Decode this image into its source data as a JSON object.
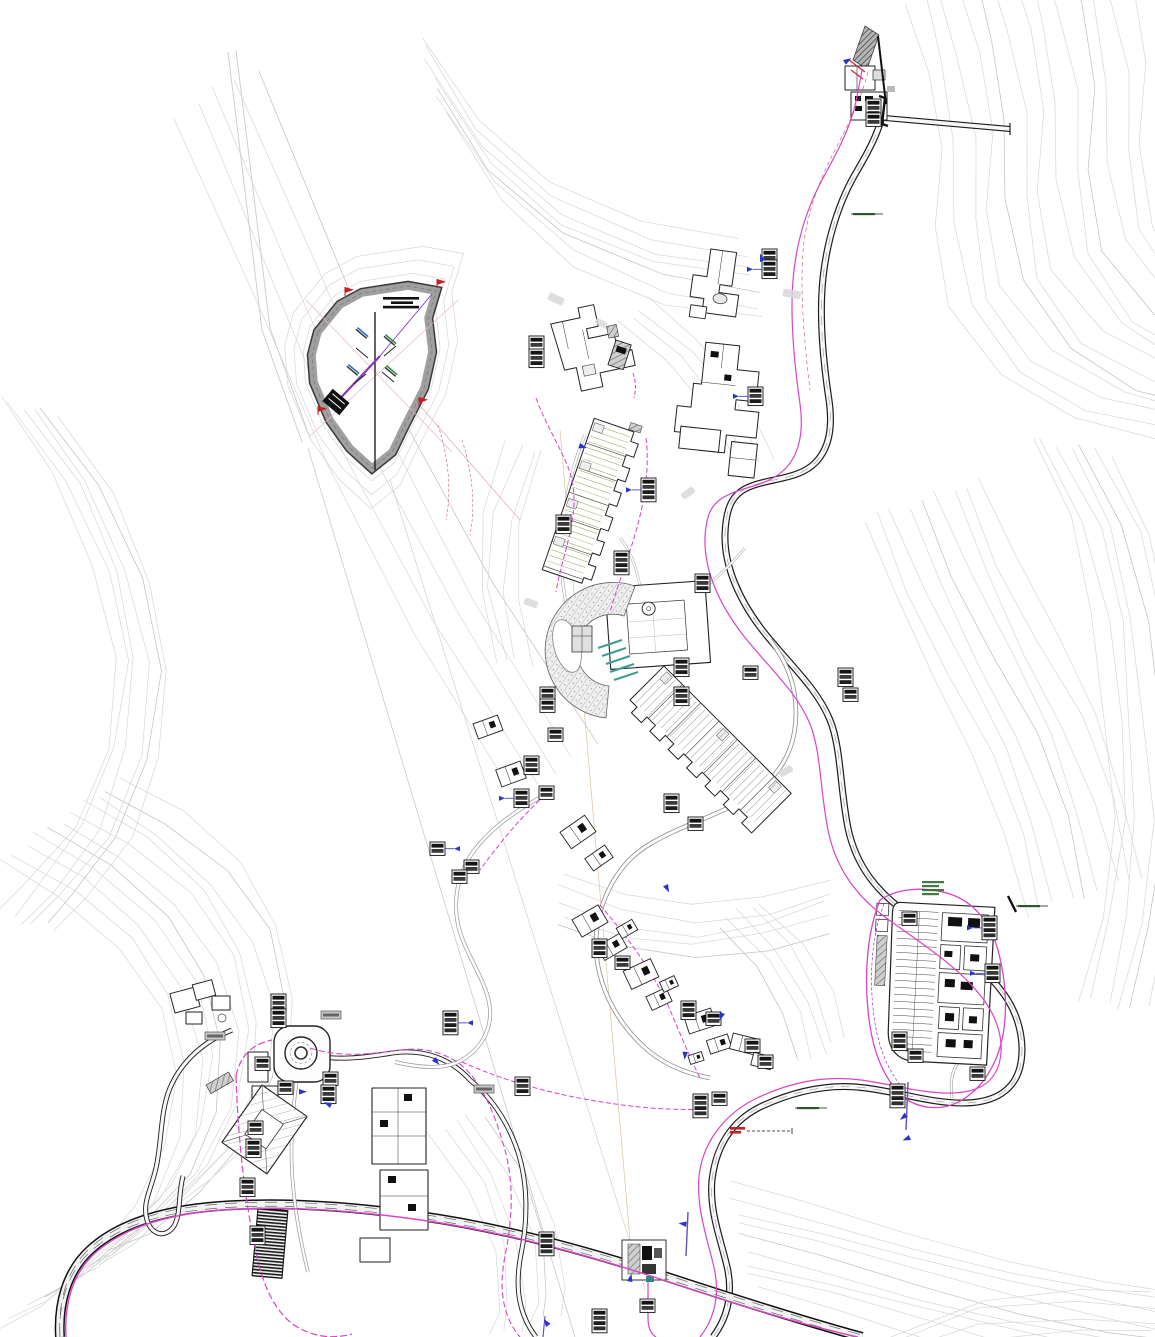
{
  "palette": {
    "background": "#ffffff",
    "contour": "#d9d9d9",
    "contour_dark": "#c2c2c2",
    "road_casing": "#1c1c1c",
    "road_fill": "#f7f7f7",
    "utility_magenta": "#d944c8",
    "utility_purple": "#8a35c0",
    "marker_blue": "#2a35c9",
    "marker_red": "#c22222",
    "building_stroke": "#222222",
    "terrace_green": "#9aa05a",
    "teal": "#3d9d96",
    "berm_gray": "#9a9a9a"
  },
  "callouts": [
    [
      866,
      99,
      3,
      ""
    ],
    [
      866,
      113,
      2,
      ""
    ],
    [
      529,
      336,
      2,
      ""
    ],
    [
      529,
      349,
      3,
      ""
    ],
    [
      641,
      478,
      4,
      "l"
    ],
    [
      556,
      515,
      3,
      ""
    ],
    [
      614,
      551,
      4,
      ""
    ],
    [
      762,
      249,
      2,
      ""
    ],
    [
      762,
      260,
      3,
      "l"
    ],
    [
      748,
      387,
      3,
      "l"
    ],
    [
      838,
      668,
      3,
      ""
    ],
    [
      843,
      688,
      2,
      ""
    ],
    [
      695,
      574,
      3,
      ""
    ],
    [
      674,
      658,
      3,
      ""
    ],
    [
      674,
      687,
      3,
      ""
    ],
    [
      743,
      666,
      2,
      ""
    ],
    [
      540,
      687,
      2,
      ""
    ],
    [
      540,
      699,
      2,
      ""
    ],
    [
      664,
      794,
      3,
      ""
    ],
    [
      688,
      817,
      2,
      ""
    ],
    [
      548,
      728,
      2,
      ""
    ],
    [
      524,
      756,
      3,
      ""
    ],
    [
      539,
      786,
      2,
      ""
    ],
    [
      514,
      789,
      3,
      "l"
    ],
    [
      430,
      842,
      2,
      "r"
    ],
    [
      464,
      860,
      2,
      ""
    ],
    [
      452,
      870,
      2,
      ""
    ],
    [
      592,
      939,
      3,
      ""
    ],
    [
      615,
      956,
      2,
      ""
    ],
    [
      681,
      1001,
      3,
      ""
    ],
    [
      706,
      1012,
      2,
      ""
    ],
    [
      745,
      1039,
      2,
      ""
    ],
    [
      758,
      1055,
      2,
      ""
    ],
    [
      271,
      994,
      3,
      ""
    ],
    [
      271,
      1009,
      3,
      ""
    ],
    [
      255,
      1057,
      2,
      ""
    ],
    [
      278,
      1081,
      2,
      ""
    ],
    [
      248,
      1121,
      2,
      ""
    ],
    [
      246,
      1139,
      3,
      ""
    ],
    [
      240,
      1178,
      3,
      ""
    ],
    [
      250,
      1226,
      3,
      ""
    ],
    [
      443,
      1011,
      4,
      "r"
    ],
    [
      515,
      1077,
      3,
      ""
    ],
    [
      539,
      1232,
      4,
      ""
    ],
    [
      592,
      1309,
      4,
      ""
    ],
    [
      693,
      1094,
      4,
      ""
    ],
    [
      712,
      1092,
      2,
      ""
    ],
    [
      890,
      1084,
      4,
      ""
    ],
    [
      982,
      916,
      4,
      "l"
    ],
    [
      985,
      964,
      3,
      "l"
    ],
    [
      902,
      912,
      2,
      ""
    ],
    [
      892,
      1032,
      3,
      ""
    ],
    [
      908,
      1049,
      2,
      ""
    ],
    [
      970,
      1067,
      2,
      ""
    ],
    [
      640,
      1299,
      2,
      ""
    ],
    [
      323,
      1072,
      2,
      ""
    ],
    [
      321,
      1085,
      3,
      ""
    ]
  ],
  "gray_tags": [
    [
      321,
      1011
    ],
    [
      474,
      1085
    ],
    [
      205,
      1032
    ]
  ],
  "flags": [
    [
      345,
      296
    ],
    [
      437,
      288
    ],
    [
      419,
      406
    ],
    [
      318,
      415
    ]
  ],
  "blue_markers": [
    [
      299,
      1089
    ],
    [
      436,
      1057
    ],
    [
      688,
      1052
    ],
    [
      908,
      1117
    ],
    [
      686,
      1227
    ],
    [
      546,
      1327
    ],
    [
      627,
      1281
    ],
    [
      843,
      60
    ],
    [
      580,
      443
    ],
    [
      668,
      884
    ],
    [
      725,
      1014
    ],
    [
      911,
      1140
    ],
    [
      330,
      1108
    ],
    [
      760,
      262
    ]
  ],
  "villas": [
    [
      488,
      727,
      26,
      16,
      -20
    ],
    [
      511,
      774,
      26,
      18,
      -20
    ],
    [
      578,
      832,
      30,
      20,
      -35
    ],
    [
      599,
      858,
      24,
      15,
      -35
    ],
    [
      590,
      921,
      30,
      20,
      -30
    ],
    [
      612,
      947,
      26,
      16,
      -30
    ],
    [
      627,
      929,
      18,
      12,
      -30
    ],
    [
      641,
      974,
      30,
      20,
      -25
    ],
    [
      659,
      999,
      22,
      15,
      -25
    ],
    [
      669,
      984,
      16,
      11,
      -25
    ],
    [
      700,
      1021,
      28,
      18,
      -18
    ],
    [
      719,
      1044,
      22,
      14,
      -18
    ],
    [
      744,
      1044,
      26,
      16,
      14
    ],
    [
      762,
      1061,
      20,
      13,
      14
    ],
    [
      696,
      1058,
      14,
      9,
      -18
    ]
  ],
  "gray_patches": [
    [
      556,
      299,
      16,
      8,
      25
    ],
    [
      688,
      493,
      14,
      7,
      -35
    ],
    [
      792,
      294,
      18,
      8,
      10
    ],
    [
      531,
      603,
      14,
      7,
      20
    ],
    [
      786,
      771,
      14,
      7,
      -30
    ],
    [
      601,
      323,
      12,
      6,
      30
    ]
  ],
  "green_labels": [
    [
      922,
      881,
      4
    ],
    [
      853,
      213,
      1
    ],
    [
      1018,
      905,
      1
    ],
    [
      797,
      1107,
      1
    ]
  ],
  "red_note": {
    "x": 730,
    "y": 1127
  },
  "pond_label": {
    "x": 383,
    "y": 297,
    "lines": 3
  }
}
